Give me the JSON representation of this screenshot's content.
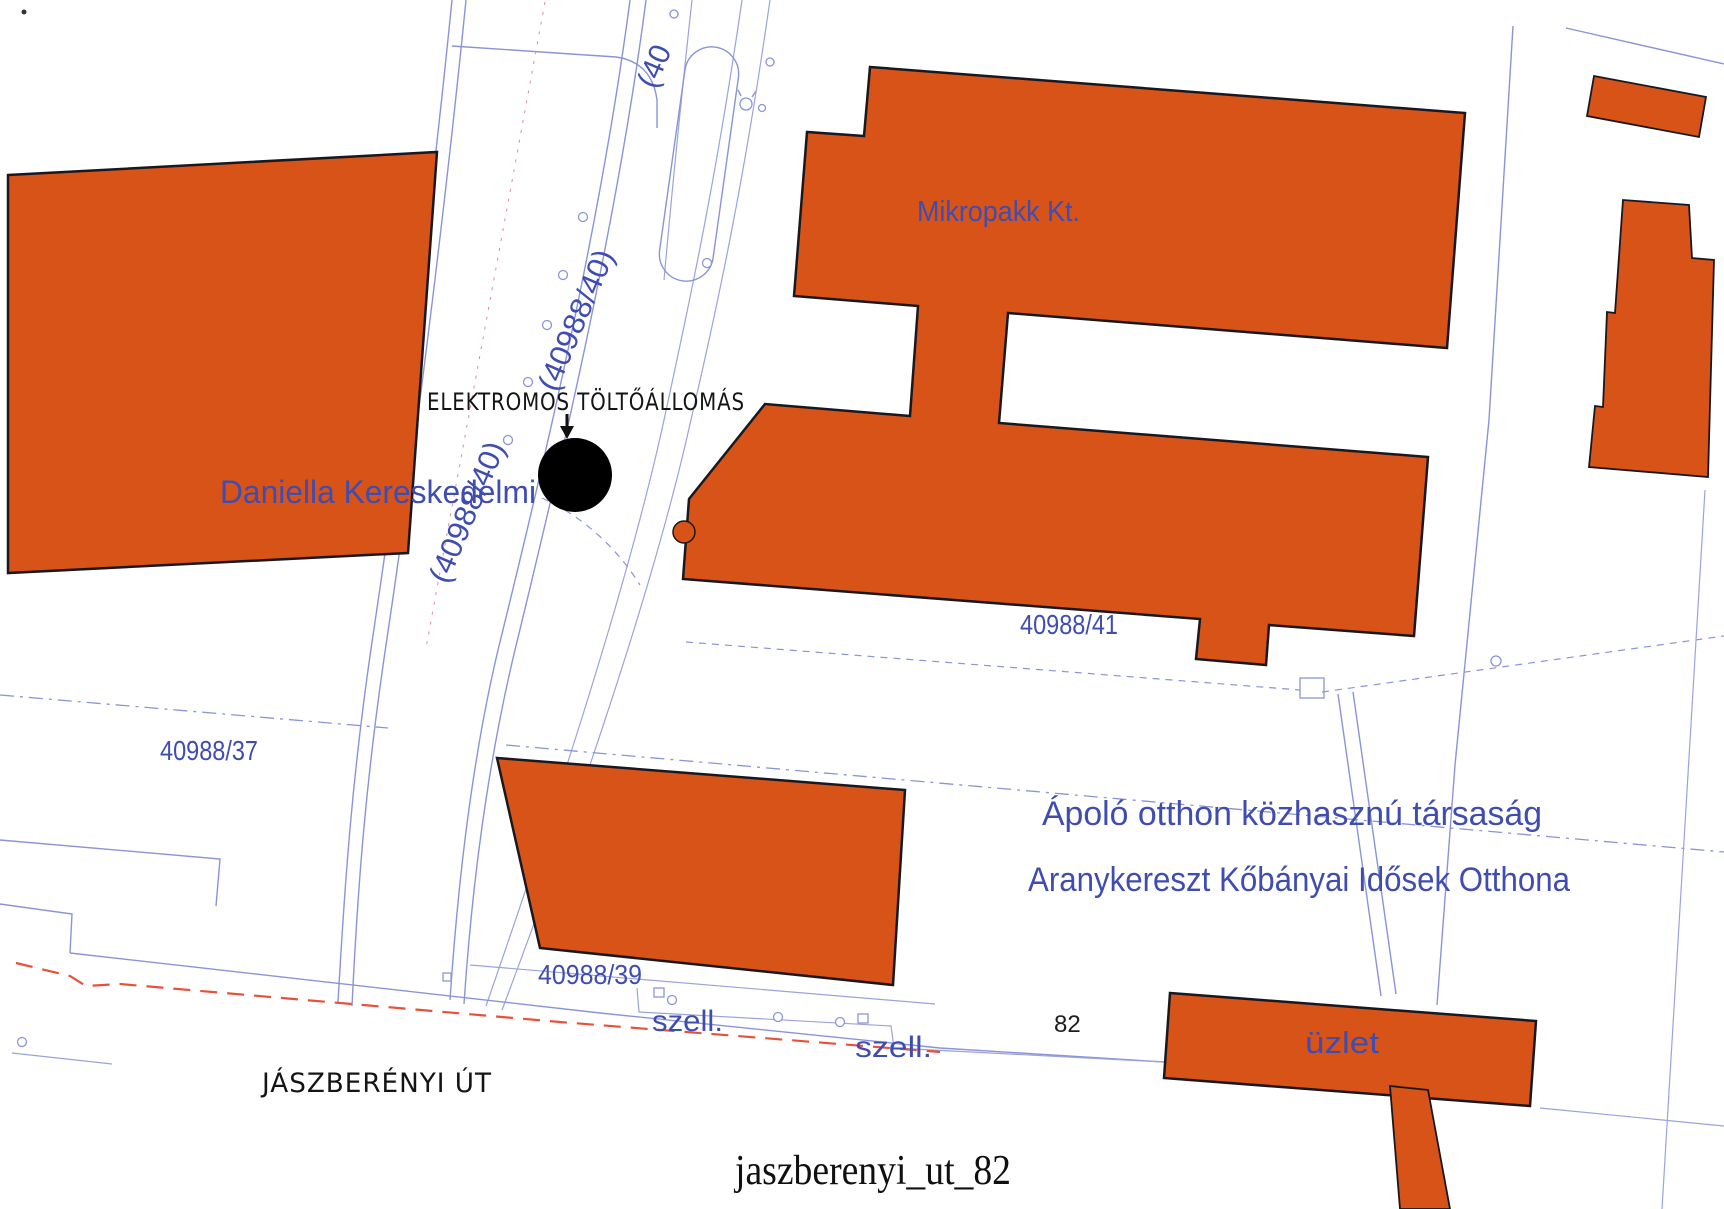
{
  "caption": "jaszberenyi_ut_82",
  "map": {
    "company_labels": {
      "mikropakk": "Mikropakk Kt.",
      "daniella": "Daniella Kereskedelmi",
      "apolo_line1": "Ápoló otthon közhasznú társaság",
      "apolo_line2": "Aranykereszt Kőbányai Idősek Otthona",
      "uzlet": "üzlet"
    },
    "parcel_labels": {
      "road_top_partial": "(40",
      "road_a": "(40988/40)",
      "road_b": "(40988/40)",
      "p41": "40988/41",
      "p37": "40988/37",
      "p39": "40988/39"
    },
    "small_labels": {
      "szell_1": "szell.",
      "szell_2": "szell.",
      "house_number": "82"
    },
    "handwritten": {
      "charging_station": "ELEKTROMOS TÖLTŐÁLLOMÁS",
      "street": "JÁSZBERÉNYI ÚT"
    },
    "colors": {
      "building_fill": "#d85317",
      "building_border": "#181820",
      "parcel_line_blue": "#8a94d6",
      "label_blue": "#3f4cb0",
      "red_dashed_line": "#e85038",
      "marker_black": "#000000"
    }
  }
}
